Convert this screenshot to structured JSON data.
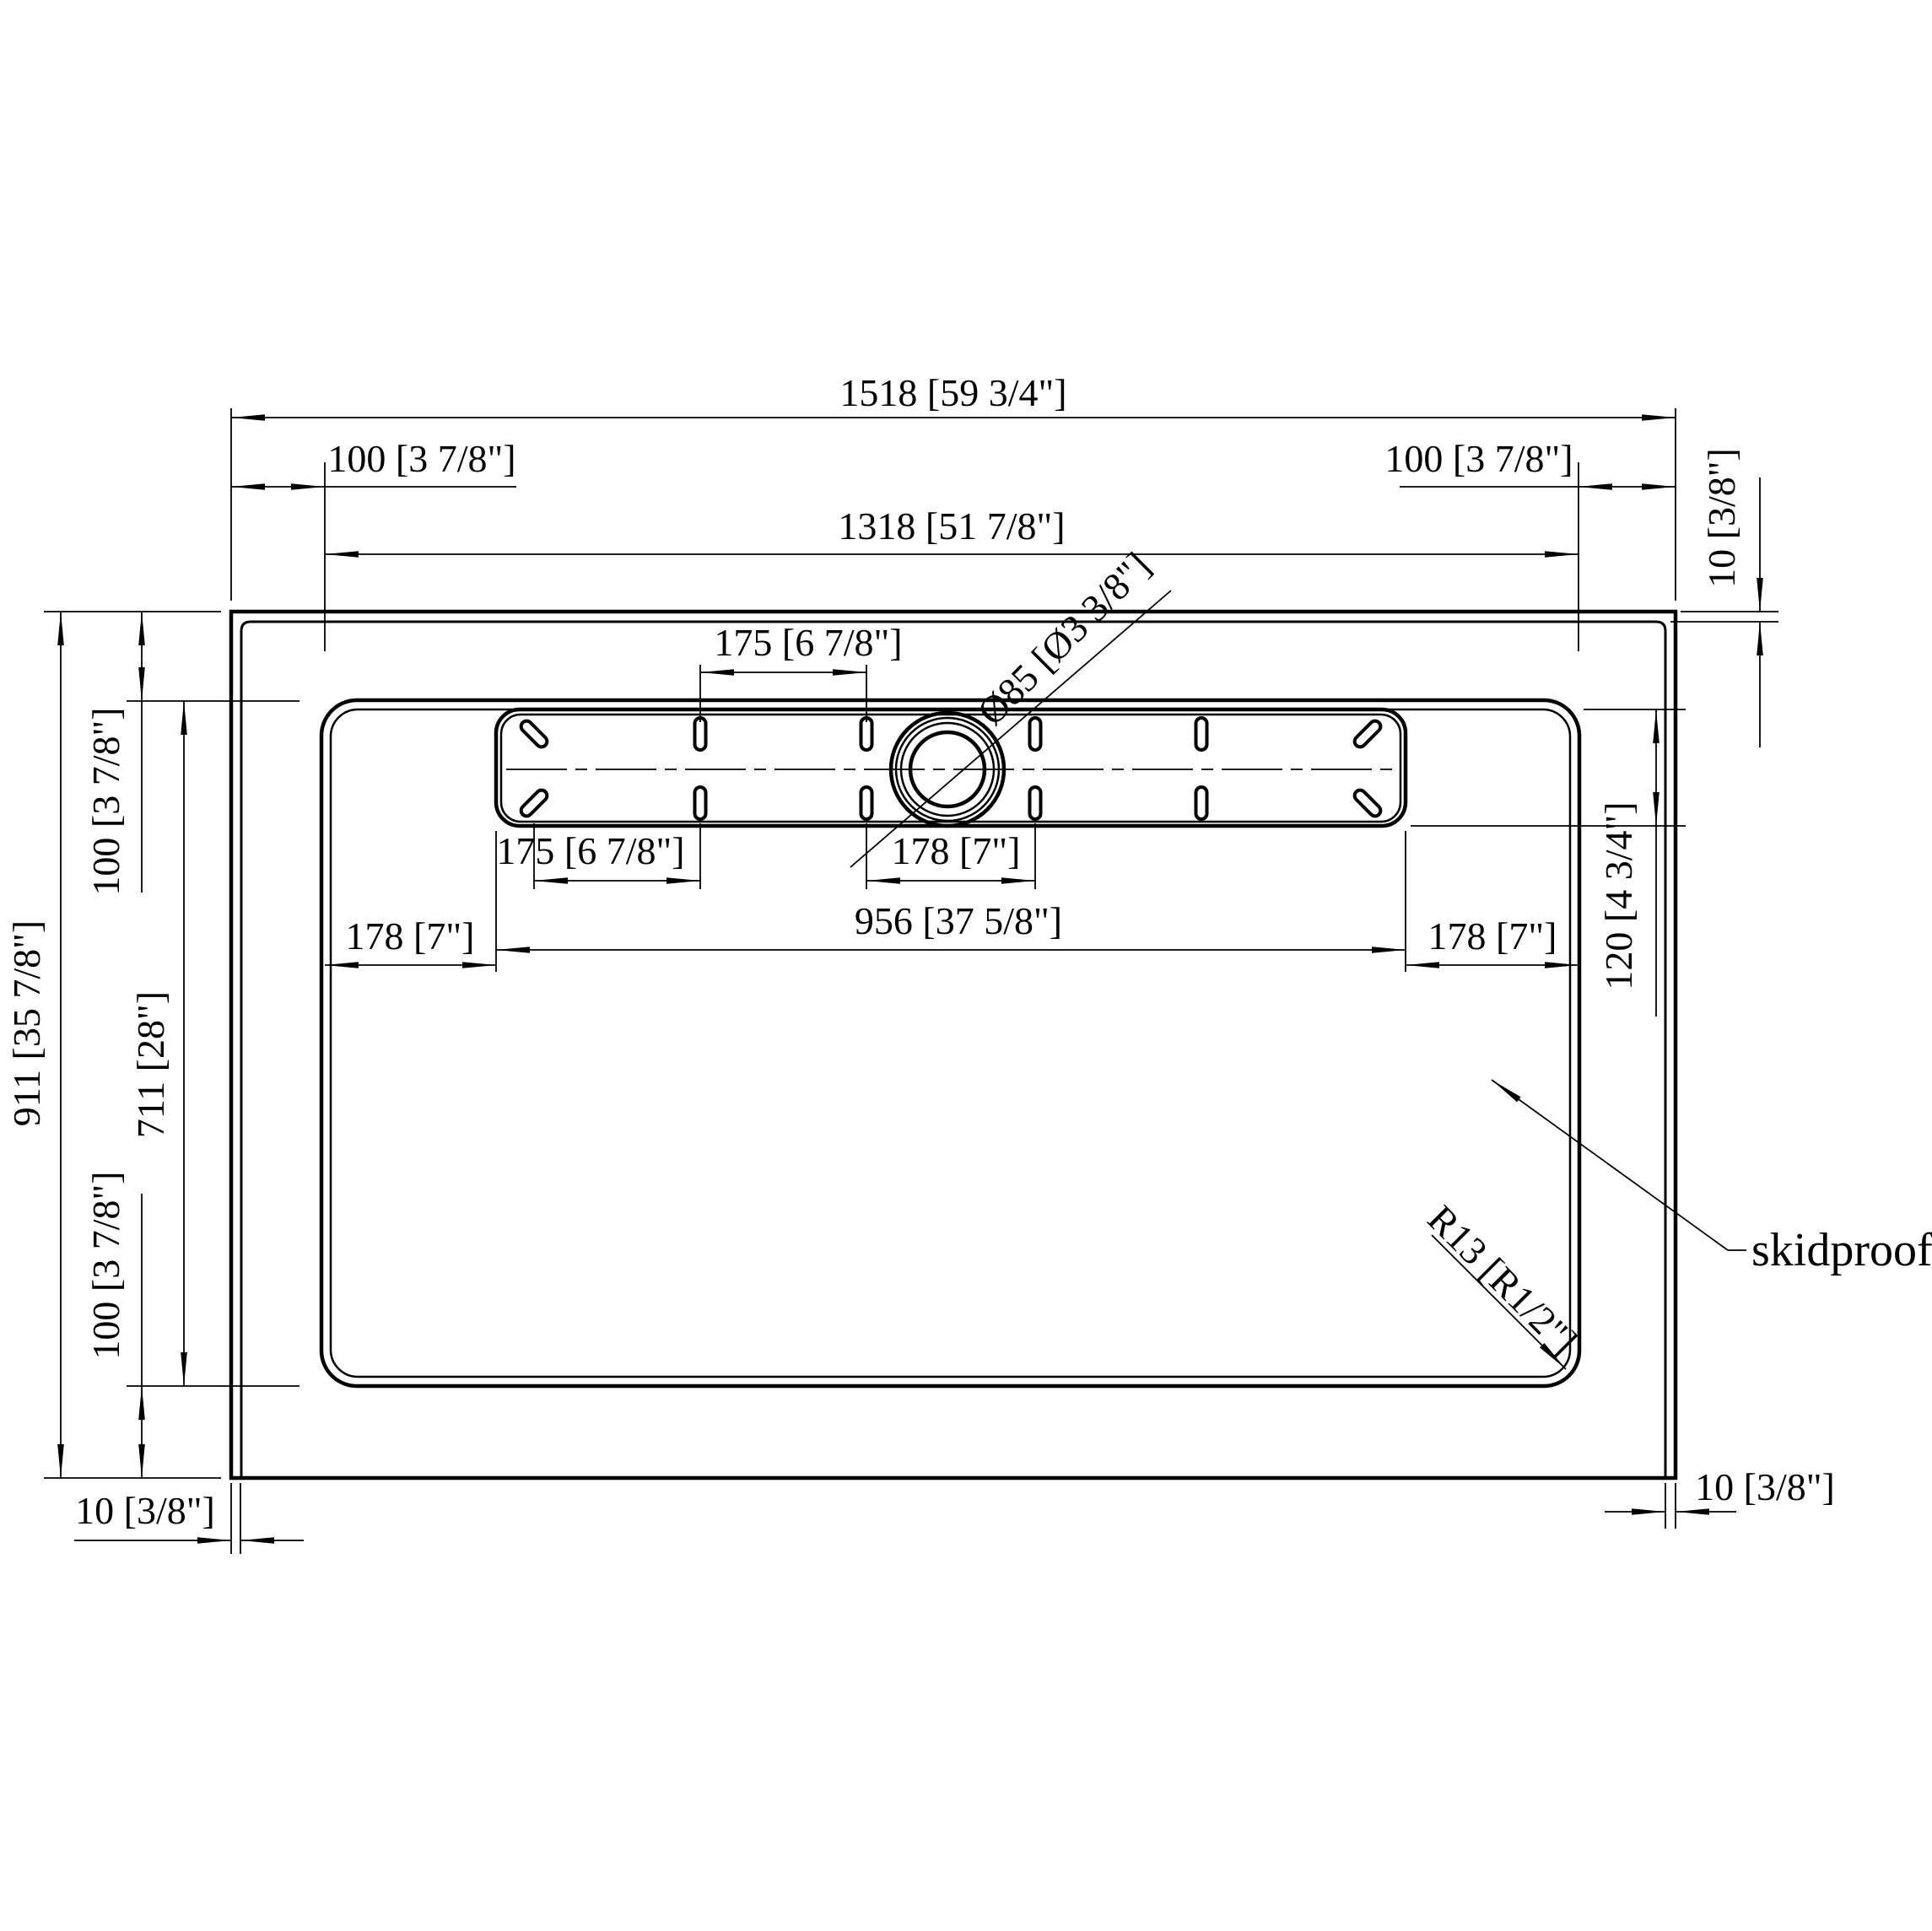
{
  "drawing": {
    "type_note": "shower base top view technical drawing",
    "colors": {
      "line": "#000000",
      "background": "#ffffff"
    }
  },
  "dimensions": {
    "overall_width": "1518 [59 3/4\"]",
    "overall_height": "911 [35 7/8\"]",
    "basin_width": "1318 [51 7/8\"]",
    "basin_height": "711 [28\"]",
    "lip": "100 [3 7/8\"]",
    "edge_step": "10 [3/8\"]",
    "slot_pitch_175": "175 [6 7/8\"]",
    "pitch_178": "178 [7\"]",
    "strip_width": "956 [37 5/8\"]",
    "strip_height": "120 [4 3/4\"]",
    "drain_diameter": "Ø85 [Ø3 3/8\"]",
    "corner_radius": "R13 [R1/2\"]"
  },
  "labels": {
    "surface": "skidproof"
  }
}
